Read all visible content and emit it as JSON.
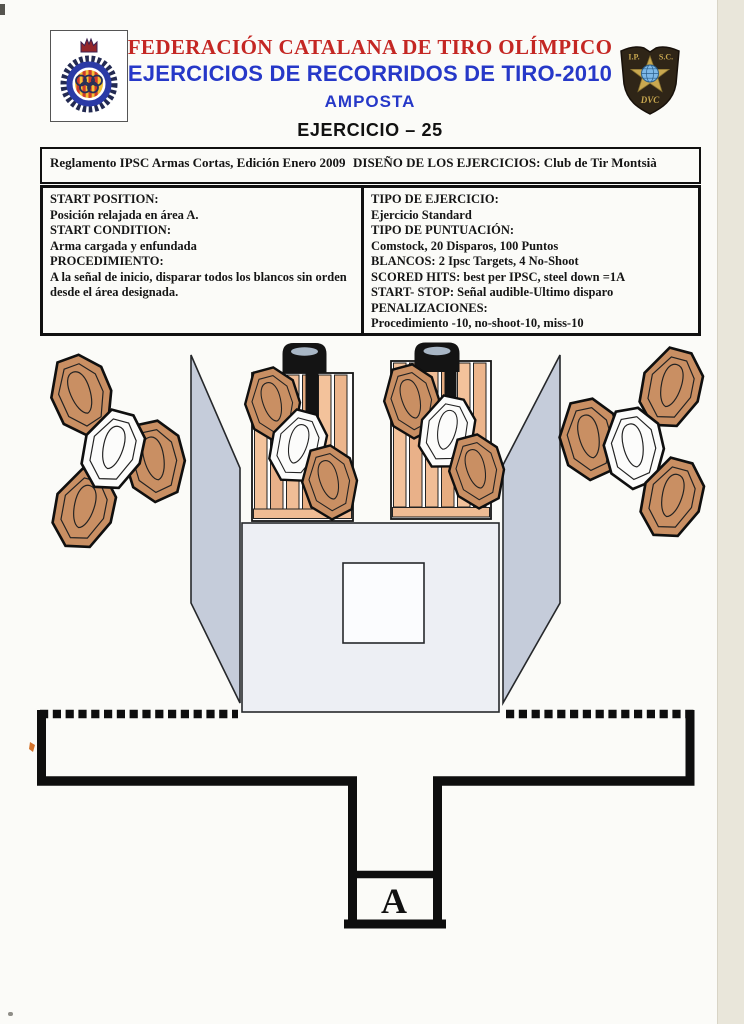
{
  "header": {
    "federation_title": "FEDERACIÓN CATALANA DE TIRO OLÍMPICO",
    "series_title": "EJERCICIOS DE RECORRIDOS DE TIRO-2010",
    "city": "AMPOSTA",
    "exercise_title": "EJERCICIO – 25",
    "title_color": "#c42723",
    "series_color": "#2638c8",
    "ipsc_shield": {
      "left": "I.P.",
      "right": "S.C.",
      "motto": "DVC"
    }
  },
  "rules_bar": {
    "regulation": "Reglamento IPSC Armas Cortas, Edición Enero 2009",
    "design": "DISEÑO DE LOS EJERCICIOS: Club de Tir Montsià"
  },
  "briefing": {
    "start_position_label": "START POSITION:",
    "start_position": "Posición relajada en área A.",
    "start_condition_label": "START CONDITION:",
    "start_condition": "Arma cargada y enfundada",
    "procedure_label": "PROCEDIMIENTO:",
    "procedure": "A la señal de inicio, disparar todos los blancos sin orden desde el área designada.",
    "exercise_type_label": "TIPO DE EJERCICIO:",
    "exercise_type": "Ejercicio Standard",
    "scoring_type_label": "TIPO DE PUNTUACIÓN:",
    "scoring_type": "Comstock, 20 Disparos, 100 Puntos",
    "targets_label": "BLANCOS:",
    "targets": "2 Ipsc Targets, 4 No-Shoot",
    "scored_hits_label": "SCORED HITS:",
    "scored_hits": "best per IPSC, steel down =1A",
    "start_stop_label": "START- STOP:",
    "start_stop": "Señal audible-Ultimo disparo",
    "penalties_label": "PENALIZACIONES:",
    "penalties": "Procedimiento -10, no-shoot-10, miss-10"
  },
  "diagram": {
    "start_area_label": "A",
    "colors": {
      "target_brown": "#c98f63",
      "no_shoot_white": "#fcfcfb",
      "wall_gray": "#c5ccda",
      "barricade_fill": "#edeff4",
      "port_fill": "#fbfcfe",
      "pallet_tan": "#f2c19a",
      "popper_black": "#141414",
      "fault_line_black": "#0e0e0e"
    }
  }
}
